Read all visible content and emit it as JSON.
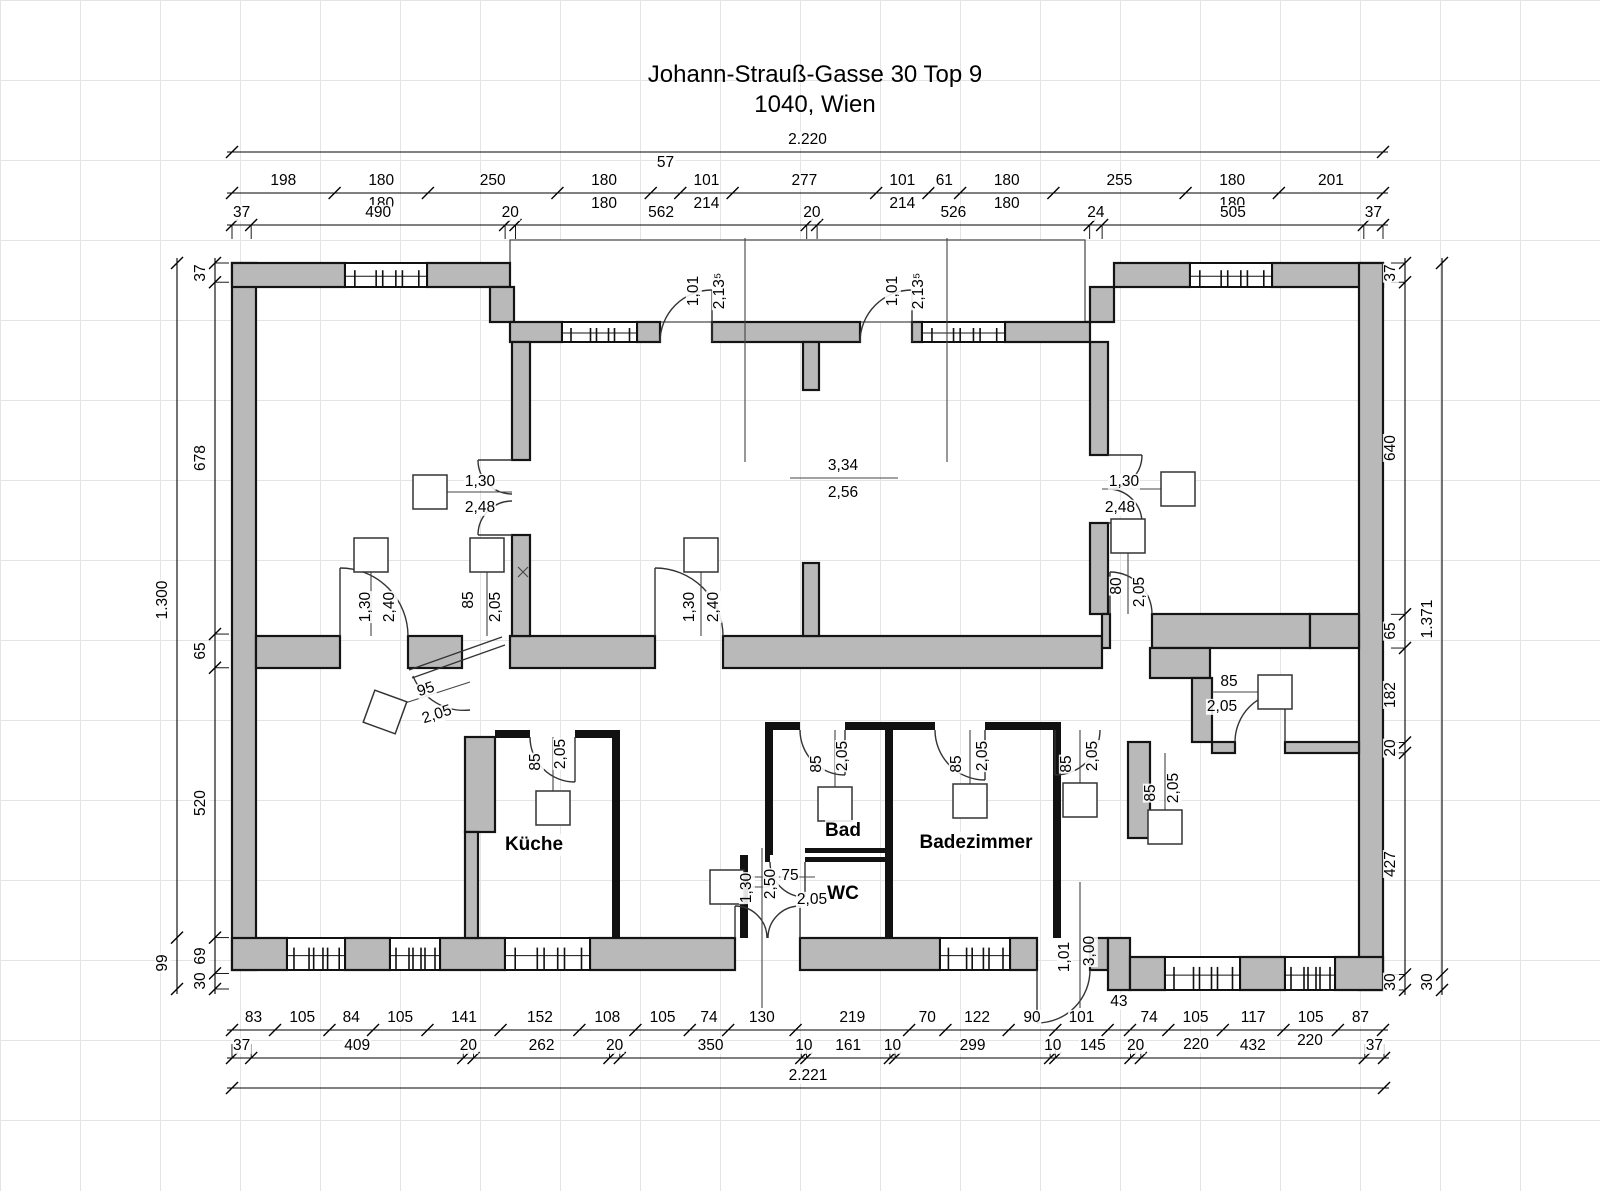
{
  "title": {
    "line1": "Johann-Strauß-Gasse 30 Top 9",
    "line2": "1040, Wien"
  },
  "colors": {
    "wall_fill": "#b9b9b9",
    "wall_stroke": "#141414",
    "thin_wall": "#111111",
    "dim_line": "#000000",
    "grid": "#e4e4e4",
    "text": "#000000"
  },
  "dim_chains": [
    {
      "id": "top-overall",
      "orient": "h",
      "pos": 152,
      "from": 232,
      "to": 1383,
      "ext": 0,
      "segments": [
        {
          "v": "2.220"
        }
      ]
    },
    {
      "id": "top-openings",
      "orient": "h",
      "pos": 193,
      "from": 232,
      "to": 1383,
      "ext": 0,
      "segments": [
        {
          "v": "198"
        },
        {
          "v": "180",
          "v2": "180"
        },
        {
          "v": "250"
        },
        {
          "v": "180",
          "v2": "180"
        },
        {
          "v": "57",
          "dy": -18
        },
        {
          "v": "101",
          "v2": "214"
        },
        {
          "v": "277"
        },
        {
          "v": "101",
          "v2": "214"
        },
        {
          "v": "61"
        },
        {
          "v": "180",
          "v2": "180"
        },
        {
          "v": "255"
        },
        {
          "v": "180",
          "v2": "180"
        },
        {
          "v": "201"
        }
      ]
    },
    {
      "id": "top-walls",
      "orient": "h",
      "pos": 225,
      "from": 232,
      "to": 1383,
      "ext": 14,
      "segments": [
        {
          "v": "37"
        },
        {
          "v": "490"
        },
        {
          "v": "20"
        },
        {
          "v": "562"
        },
        {
          "v": "20"
        },
        {
          "v": "526"
        },
        {
          "v": "24"
        },
        {
          "v": "505"
        },
        {
          "v": "37"
        }
      ]
    },
    {
      "id": "bottom-openings",
      "orient": "h",
      "pos": 1030,
      "from": 232,
      "to": 1383,
      "ext": 0,
      "segments": [
        {
          "v": "83"
        },
        {
          "v": "105"
        },
        {
          "v": "84"
        },
        {
          "v": "105"
        },
        {
          "v": "141"
        },
        {
          "v": "152"
        },
        {
          "v": "108"
        },
        {
          "v": "105"
        },
        {
          "v": "74"
        },
        {
          "v": "130"
        },
        {
          "v": "219"
        },
        {
          "v": "70"
        },
        {
          "v": "122"
        },
        {
          "v": "90"
        },
        {
          "v": "101"
        },
        {
          "v": "43",
          "dy": -16
        },
        {
          "v": "74"
        },
        {
          "v": "105"
        },
        {
          "v": "117"
        },
        {
          "v": "105"
        },
        {
          "v": "87"
        }
      ]
    },
    {
      "id": "bottom-walls",
      "orient": "h",
      "pos": 1058,
      "from": 232,
      "to": 1384,
      "ext": -14,
      "segments": [
        {
          "v": "37"
        },
        {
          "v": "409"
        },
        {
          "v": "20"
        },
        {
          "v": "262"
        },
        {
          "v": "20"
        },
        {
          "v": "350"
        },
        {
          "v": "10"
        },
        {
          "v": "161"
        },
        {
          "v": "10"
        },
        {
          "v": "299"
        },
        {
          "v": "10"
        },
        {
          "v": "145"
        },
        {
          "v": "20"
        },
        {
          "v": "432"
        },
        {
          "v": "37"
        }
      ]
    },
    {
      "id": "bottom-overall",
      "orient": "h",
      "pos": 1088,
      "from": 232,
      "to": 1384,
      "ext": 0,
      "segments": [
        {
          "v": "2.221"
        }
      ]
    },
    {
      "id": "left-outer",
      "orient": "v",
      "pos": 177,
      "from": 263,
      "to": 989,
      "ext": 0,
      "segments": [
        {
          "v": "1.300"
        },
        {
          "v": "99"
        }
      ]
    },
    {
      "id": "left-inner",
      "orient": "v",
      "pos": 215,
      "from": 263,
      "to": 989,
      "ext": 14,
      "segments": [
        {
          "v": "37"
        },
        {
          "v": "678"
        },
        {
          "v": "65"
        },
        {
          "v": "520"
        },
        {
          "v": "69"
        },
        {
          "v": "30"
        }
      ]
    },
    {
      "id": "right-inner",
      "orient": "v",
      "pos": 1405,
      "from": 263,
      "to": 990,
      "ext": -14,
      "segments": [
        {
          "v": "37"
        },
        {
          "v": "640"
        },
        {
          "v": "65"
        },
        {
          "v": "182"
        },
        {
          "v": "20"
        },
        {
          "v": "427"
        },
        {
          "v": "30"
        }
      ]
    },
    {
      "id": "right-outer",
      "orient": "v",
      "pos": 1442,
      "from": 263,
      "to": 990,
      "ext": 0,
      "segments": [
        {
          "v": "1.371"
        },
        {
          "v": "30"
        }
      ]
    }
  ],
  "labels": [
    {
      "text": "3,34",
      "x": 843,
      "y": 466
    },
    {
      "text": "2,56",
      "x": 843,
      "y": 493
    },
    {
      "text": "1,30",
      "x": 480,
      "y": 482
    },
    {
      "text": "2,48",
      "x": 480,
      "y": 508
    },
    {
      "text": "1,30",
      "x": 1124,
      "y": 482
    },
    {
      "text": "2,48",
      "x": 1120,
      "y": 508
    },
    {
      "text": "1,01",
      "x": 694,
      "y": 291,
      "rot": -90
    },
    {
      "text": "2,13⁵",
      "x": 720,
      "y": 291,
      "rot": -90
    },
    {
      "text": "1,01",
      "x": 893,
      "y": 291,
      "rot": -90
    },
    {
      "text": "2,13⁵",
      "x": 919,
      "y": 291,
      "rot": -90
    },
    {
      "text": "1,30",
      "x": 366,
      "y": 607,
      "rot": -90
    },
    {
      "text": "2,40",
      "x": 390,
      "y": 607,
      "rot": -90
    },
    {
      "text": "85",
      "x": 469,
      "y": 600,
      "rot": -90
    },
    {
      "text": "2,05",
      "x": 496,
      "y": 607,
      "rot": -90
    },
    {
      "text": "1,30",
      "x": 690,
      "y": 607,
      "rot": -90
    },
    {
      "text": "2,40",
      "x": 714,
      "y": 607,
      "rot": -90
    },
    {
      "text": "80",
      "x": 1117,
      "y": 586,
      "rot": -90
    },
    {
      "text": "2,05",
      "x": 1140,
      "y": 592,
      "rot": -90
    },
    {
      "text": "95",
      "x": 426,
      "y": 690,
      "rot": -18
    },
    {
      "text": "2,05",
      "x": 437,
      "y": 715,
      "rot": -18
    },
    {
      "text": "85",
      "x": 1229,
      "y": 682
    },
    {
      "text": "2,05",
      "x": 1222,
      "y": 707
    },
    {
      "text": "85",
      "x": 536,
      "y": 762,
      "rot": -90
    },
    {
      "text": "2,05",
      "x": 561,
      "y": 754,
      "rot": -90
    },
    {
      "text": "85",
      "x": 817,
      "y": 764,
      "rot": -90
    },
    {
      "text": "2,05",
      "x": 843,
      "y": 756,
      "rot": -90
    },
    {
      "text": "85",
      "x": 957,
      "y": 764,
      "rot": -90
    },
    {
      "text": "2,05",
      "x": 983,
      "y": 756,
      "rot": -90
    },
    {
      "text": "85",
      "x": 1067,
      "y": 764,
      "rot": -90
    },
    {
      "text": "2,05",
      "x": 1093,
      "y": 756,
      "rot": -90
    },
    {
      "text": "85",
      "x": 1151,
      "y": 793,
      "rot": -90
    },
    {
      "text": "2,05",
      "x": 1174,
      "y": 788,
      "rot": -90
    },
    {
      "text": "1,30",
      "x": 747,
      "y": 888,
      "rot": -90
    },
    {
      "text": "2,50",
      "x": 771,
      "y": 884,
      "rot": -90
    },
    {
      "text": "75",
      "x": 790,
      "y": 876
    },
    {
      "text": "2,05",
      "x": 812,
      "y": 900
    },
    {
      "text": "1,01",
      "x": 1065,
      "y": 957,
      "rot": -90
    },
    {
      "text": "3,00",
      "x": 1090,
      "y": 951,
      "rot": -90
    },
    {
      "text": "220",
      "x": 1196,
      "y": 1045
    },
    {
      "text": "220",
      "x": 1310,
      "y": 1041
    }
  ],
  "rooms": [
    {
      "name": "Küche",
      "x": 534,
      "y": 845
    },
    {
      "name": "Bad",
      "x": 843,
      "y": 831
    },
    {
      "name": "Badezimmer",
      "x": 976,
      "y": 843
    },
    {
      "name": "WC",
      "x": 843,
      "y": 894
    }
  ]
}
